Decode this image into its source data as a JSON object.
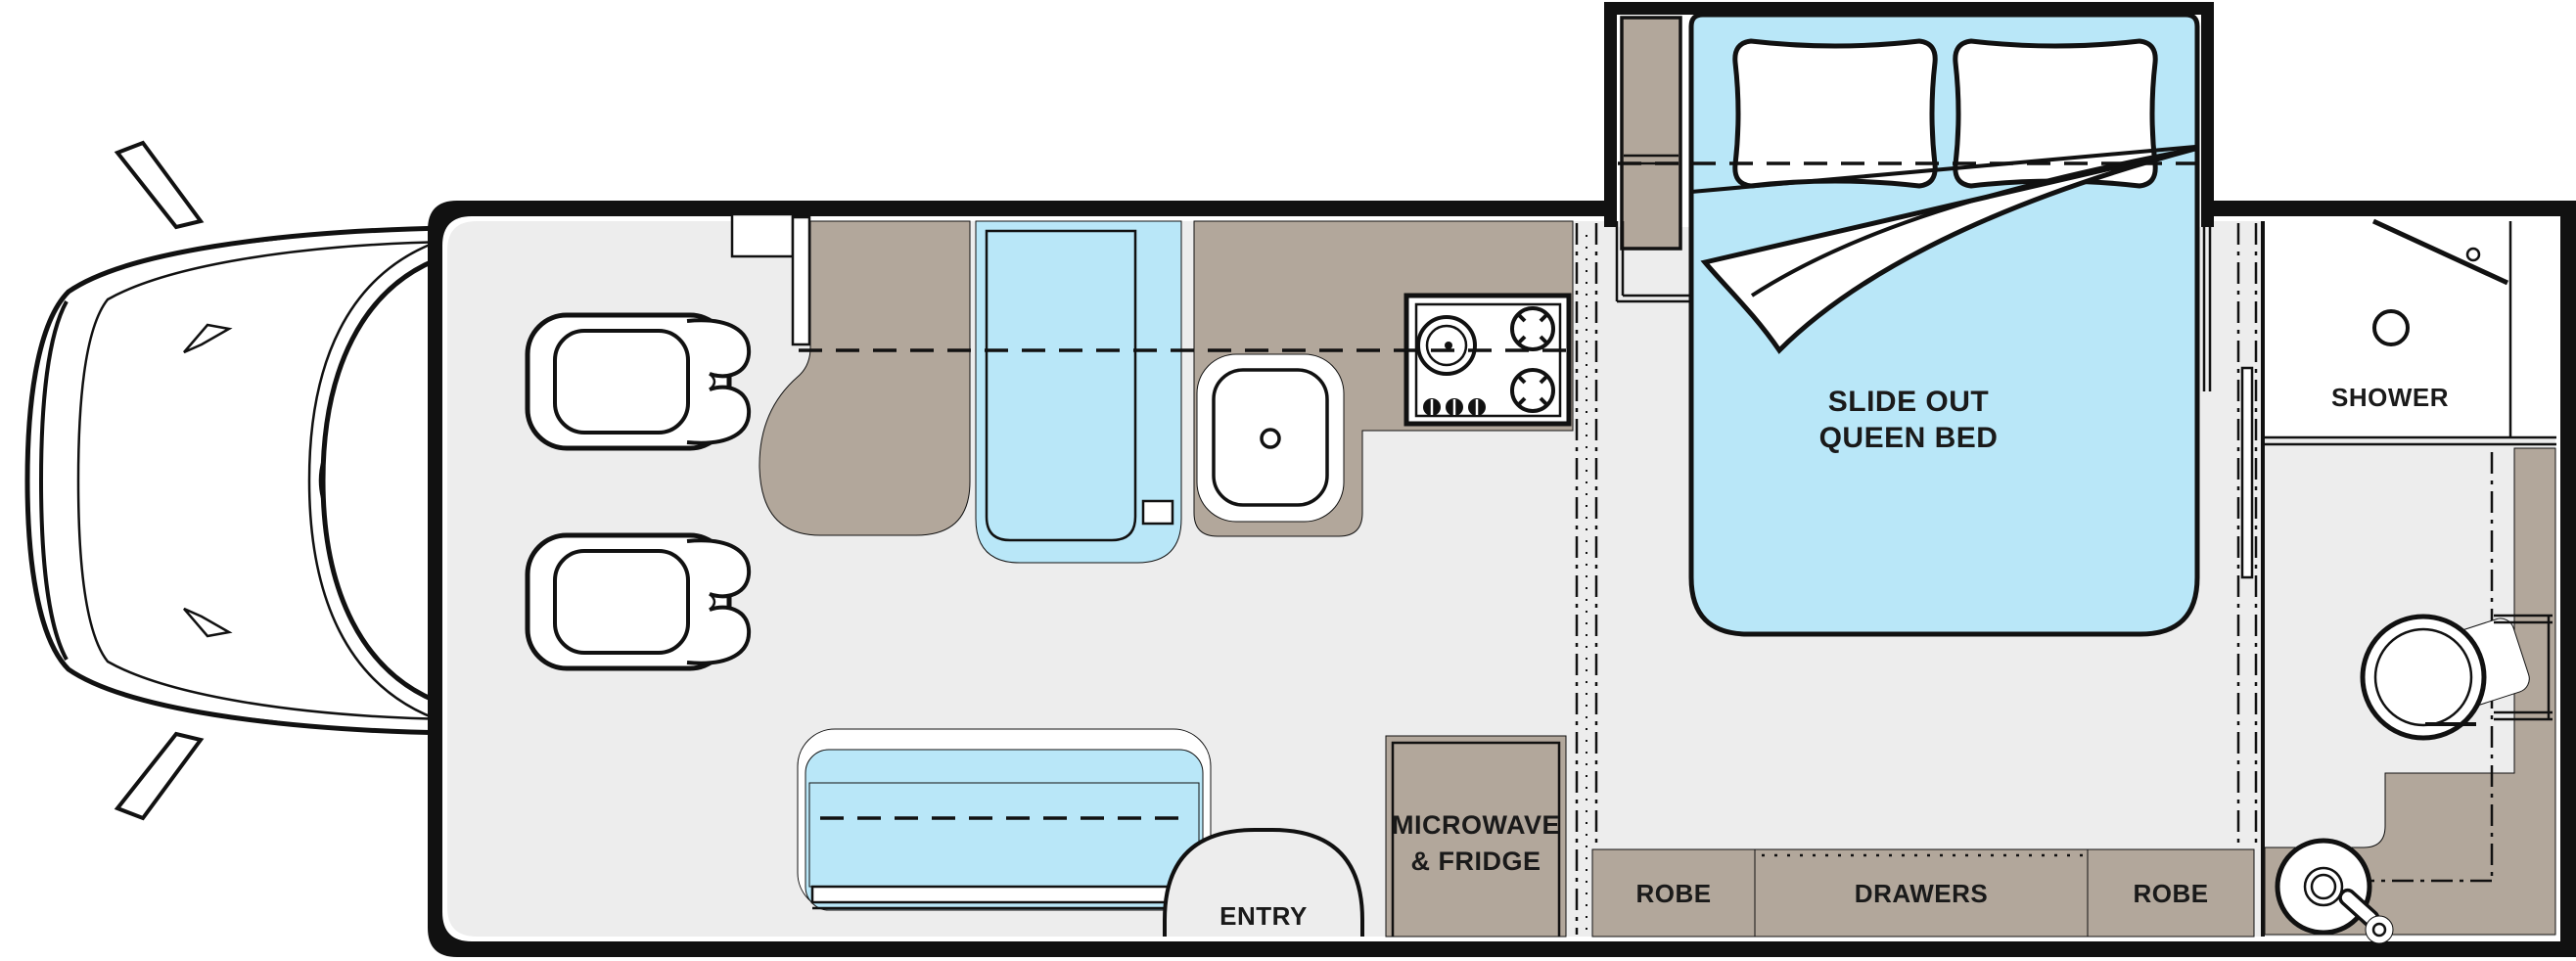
{
  "diagram": {
    "type": "rv-floor-plan",
    "labels": {
      "bed_line1": "SLIDE OUT",
      "bed_line2": "QUEEN BED",
      "shower": "SHOWER",
      "microwave_line1": "MICROWAVE",
      "microwave_line2": "& FRIDGE",
      "entry": "ENTRY",
      "robe_left": "ROBE",
      "drawers": "DRAWERS",
      "robe_right": "ROBE"
    },
    "colors": {
      "background": "#ffffff",
      "floor": "#ededed",
      "cabinet_tan": "#b2a79b",
      "cushion_blue": "#b9e7f8",
      "outline": "#111111"
    }
  }
}
